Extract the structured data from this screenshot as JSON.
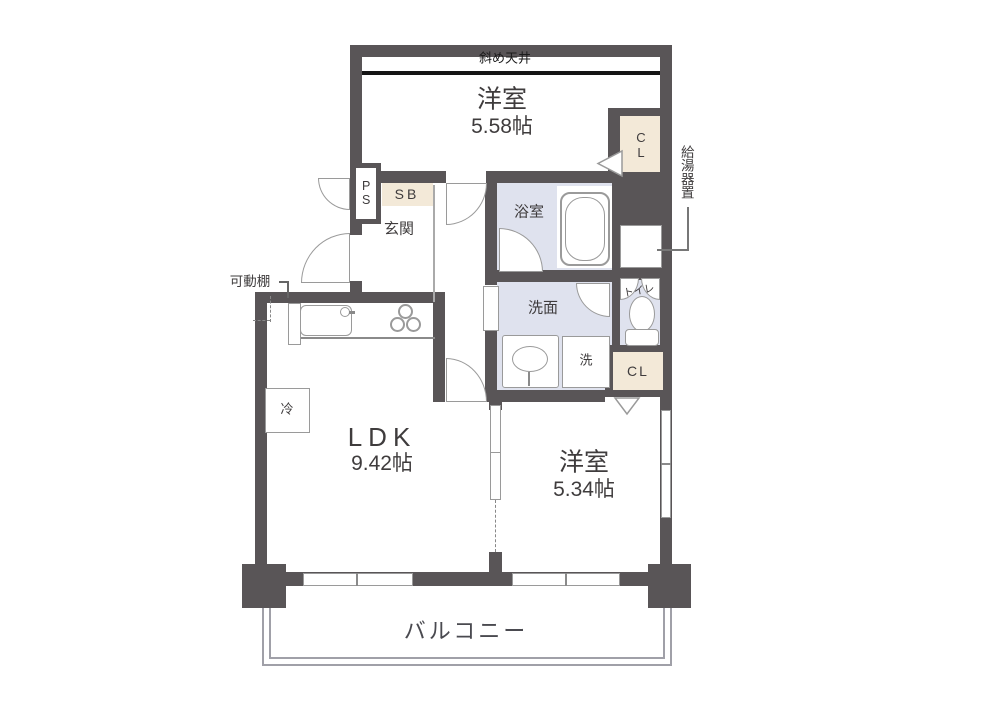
{
  "rooms": {
    "bedroom_top": {
      "name": "洋室",
      "size": "5.58帖"
    },
    "ldk": {
      "name": "LDK",
      "size": "9.42帖"
    },
    "bedroom_right": {
      "name": "洋室",
      "size": "5.34帖"
    },
    "entrance": {
      "name": "玄関"
    },
    "bathroom": {
      "name": "浴室"
    },
    "washroom": {
      "name": "洗面"
    },
    "toilet": {
      "name": "トイレ"
    },
    "balcony": {
      "name": "バルコニー"
    }
  },
  "features": {
    "slanted_ceiling": "斜め天井",
    "closet_top": "CL",
    "closet_bottom": "CL",
    "pipe_space": "PS",
    "shoe_box": "SB",
    "laundry": "洗",
    "refrigerator": "冷",
    "water_heater": "給湯器置",
    "movable_shelf": "可動棚"
  },
  "colors": {
    "wall": "#595557",
    "wet_area": "#dfe2ee",
    "closet_fill": "#f3e9d8",
    "fixture_outline": "#9a9a9a",
    "ceiling_line": "#151515",
    "text": "#3f3c3d"
  }
}
